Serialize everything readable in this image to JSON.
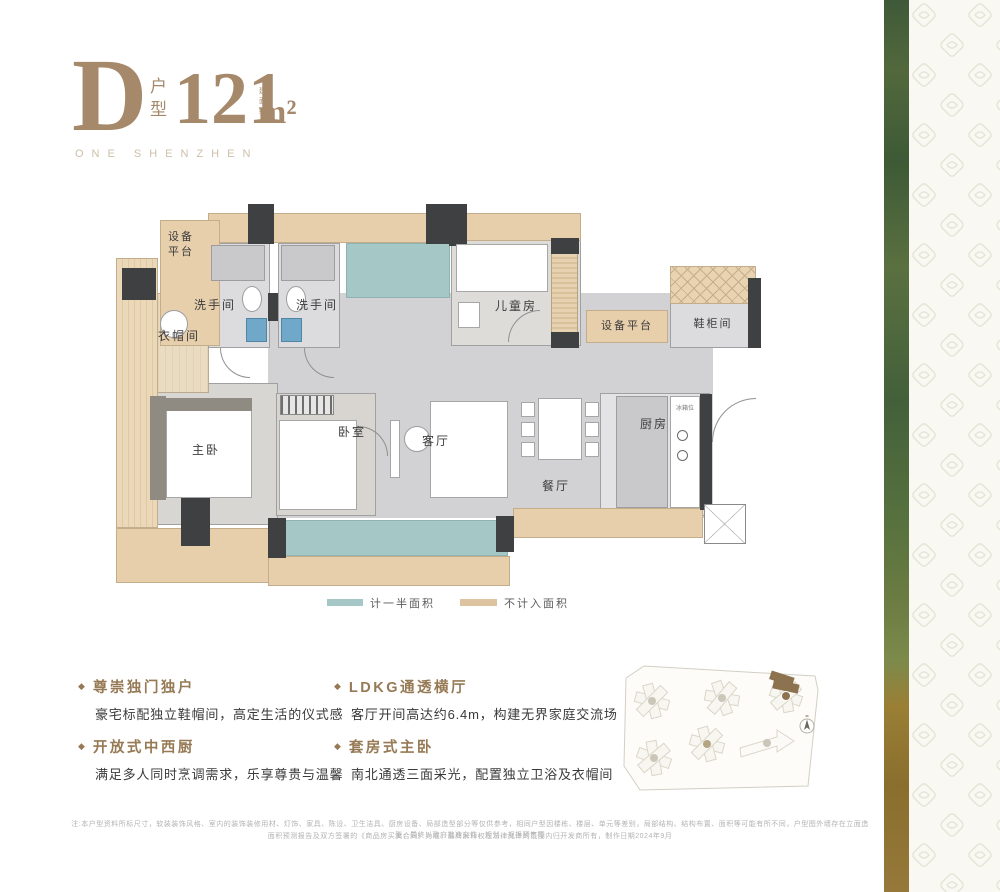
{
  "header": {
    "unit_letter": "D",
    "unit_type": "户型",
    "area_prefix": "建面约",
    "area_value": "121",
    "area_unit": "m²",
    "brand": "ONE SHENZHEN"
  },
  "floorplan": {
    "rooms": {
      "equipment_platform_left": "设备平台",
      "bathroom_1": "洗手间",
      "bathroom_2": "洗手间",
      "cloakroom": "衣帽间",
      "children_room": "儿童房",
      "equipment_platform_right": "设备平台",
      "shoe_cabinet_room": "鞋柜间",
      "master_bedroom": "主卧",
      "bedroom": "卧室",
      "living_room": "客厅",
      "dining_room": "餐厅",
      "kitchen": "厨房",
      "fridge_spot": "冰箱位"
    },
    "legend": {
      "half_area": {
        "label": "计一半面积",
        "color": "#a5c8c6"
      },
      "excluded_area": {
        "label": "不计入面积",
        "color": "#ddc3a0"
      }
    }
  },
  "features": [
    {
      "title": "尊崇独门独户",
      "desc": "豪宅标配独立鞋帽间，高定生活的仪式感"
    },
    {
      "title": "开放式中西厨",
      "desc": "满足多人同时烹调需求，乐享尊贵与温馨"
    },
    {
      "title": "LDKG通透横厅",
      "desc": "客厅开间高达约6.4m，构建无界家庭交流场"
    },
    {
      "title": "套房式主卧",
      "desc": "南北通透三面采光，配置独立卫浴及衣帽间"
    }
  ],
  "disclaimer": {
    "line1": "注:本户型资料所标尺寸，软装装饰风格、室内的装饰装修用材、灯饰、家具、陈设、卫生洁具、厨房设备、局部造型部分等仅供参考，相同户型因楼栋、楼层、单元等差别，局部结构、结构布置、面积等可能有所不同，户型图外墙存在立面造型，最终以政府批准文件、规划、规报预售等",
    "line2": "面积预测报告及双方签署的《商品房买卖合同》为准，最终解释权在法律允许的范围内归开发商所有，制作日期2024年9月"
  },
  "colors": {
    "accent_brown": "#a5896a",
    "tan": "#e8cfac",
    "teal": "#a5c8c6",
    "wall_dark": "#3f4042",
    "highlight_building": "#8d7250"
  }
}
